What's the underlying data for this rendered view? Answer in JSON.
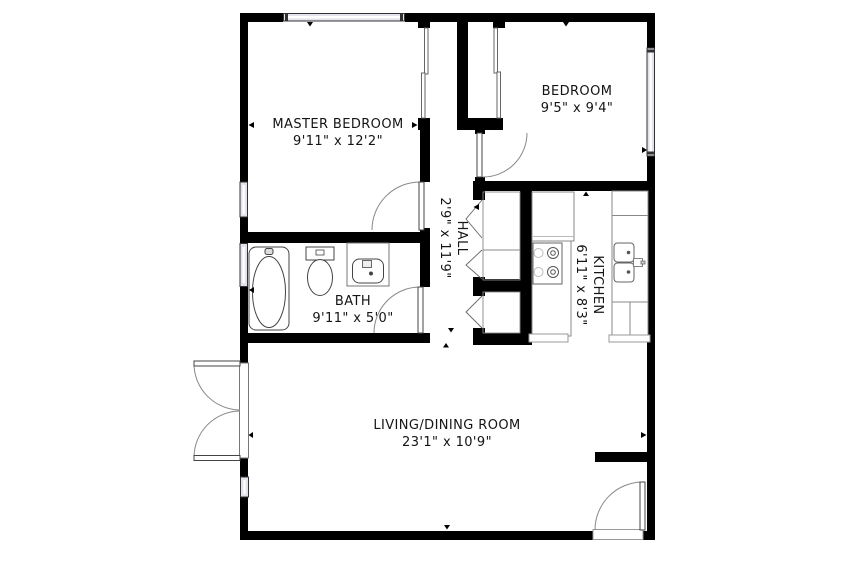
{
  "plan": {
    "type": "apartment-floor-plan",
    "colors": {
      "background": "#ffffff",
      "walls": "#000000",
      "window_fill": "#e3e3ee",
      "fixture_outline": "#555555",
      "door_arc": "#888888",
      "text": "#141414"
    },
    "rooms": {
      "master_bedroom": {
        "name": "MASTER BEDROOM",
        "size": "9'11\" x 12'2\""
      },
      "bedroom": {
        "name": "BEDROOM",
        "size": "9'5\" x 9'4\""
      },
      "hall": {
        "name": "HALL",
        "size": "2'9\" x 11'9\""
      },
      "kitchen": {
        "name": "KITCHEN",
        "size": "6'11\" x 8'3\""
      },
      "bath": {
        "name": "BATH",
        "size": "9'11\" x 5'0\""
      },
      "living_dining": {
        "name": "LIVING/DINING ROOM",
        "size": "23'1\" x 10'9\""
      }
    },
    "fixtures": {
      "bath": [
        "bathtub-icon",
        "toilet-icon",
        "vanity-sink-icon"
      ],
      "kitchen": [
        "refrigerator-icon",
        "stove-icon",
        "counter-icon",
        "double-sink-icon"
      ],
      "doors": [
        "double-entry-door",
        "living-room-exterior-door",
        "master-bedroom-door",
        "bedroom-door",
        "bath-door",
        "closet-bifold-doors",
        "closet-sliding-doors"
      ],
      "windows_count": 5
    }
  }
}
